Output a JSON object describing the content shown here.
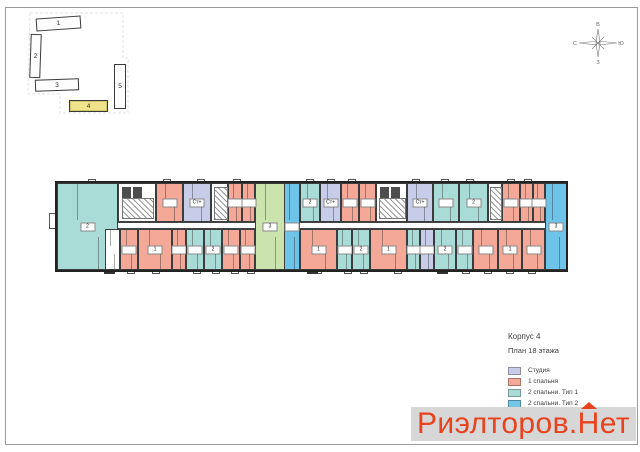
{
  "info": {
    "title": "Корпус 4",
    "subtitle": "План 18 этажа"
  },
  "legend": {
    "items": [
      {
        "label": "Студия",
        "color": "#c7cce9"
      },
      {
        "label": "1 спальня",
        "color": "#f4a897"
      },
      {
        "label": "2 спальни. Тип 1",
        "color": "#a9dcd6"
      },
      {
        "label": "2 спальни. Тип 2",
        "color": "#74c6e6"
      },
      {
        "label": "3 спальни",
        "color": "#cbe3ac"
      }
    ]
  },
  "watermark": {
    "prefix": "Риэлторов.",
    "n": "Н",
    "suffix": "ет",
    "color": "#e8421e",
    "band_color": "#d7d7d7"
  },
  "compass": {
    "top": "В",
    "right": "Ю",
    "bottom": "З",
    "left": "С"
  },
  "keyplan": {
    "highlight_color": "#efe48c",
    "bars": [
      {
        "num": "1",
        "x": 36,
        "y": 17,
        "w": 45,
        "h": 13,
        "rot": -4,
        "highlight": false
      },
      {
        "num": "2",
        "x": 30,
        "y": 34,
        "w": 11,
        "h": 44,
        "rot": 2,
        "highlight": false
      },
      {
        "num": "3",
        "x": 35,
        "y": 79,
        "w": 44,
        "h": 12,
        "rot": -2,
        "highlight": false
      },
      {
        "num": "4",
        "x": 69,
        "y": 100,
        "w": 39,
        "h": 12,
        "rot": 0,
        "highlight": true
      },
      {
        "num": "5",
        "x": 114,
        "y": 64,
        "w": 12,
        "h": 45,
        "rot": 0,
        "highlight": false
      }
    ]
  },
  "plan": {
    "colors": {
      "studio": "#c7cce9",
      "bed1": "#f4a897",
      "bed2t1": "#a9dcd6",
      "bed2t2": "#6ec3e8",
      "bed3": "#cbe3ac",
      "white": "#ffffff"
    },
    "geometry": {
      "left": 57,
      "right": 567,
      "top": 183,
      "corridor_top": 222,
      "corridor_h": 7,
      "bottom": 270
    },
    "corridors": [
      {
        "x": 100,
        "w": 155
      },
      {
        "x": 300,
        "w": 245
      }
    ],
    "units": [
      {
        "row": "full",
        "x": 57,
        "w": 61,
        "c": "bed2t1",
        "tag": "2"
      },
      {
        "row": "full",
        "x": 255,
        "w": 30,
        "c": "bed3",
        "tag": "3"
      },
      {
        "row": "full",
        "x": 284,
        "w": 16,
        "c": "bed2t2",
        "tag": ""
      },
      {
        "row": "full",
        "x": 545,
        "w": 22,
        "c": "bed2t2",
        "tag": "3"
      },
      {
        "row": "top",
        "x": 156,
        "w": 27,
        "c": "bed1",
        "tag": ""
      },
      {
        "row": "top",
        "x": 183,
        "w": 28,
        "c": "studio",
        "tag": "Ст+"
      },
      {
        "row": "top",
        "x": 228,
        "w": 14,
        "c": "bed1",
        "tag": ""
      },
      {
        "row": "top",
        "x": 242,
        "w": 13,
        "c": "bed1",
        "tag": ""
      },
      {
        "row": "top",
        "x": 300,
        "w": 20,
        "c": "bed2t1",
        "tag": "2"
      },
      {
        "row": "top",
        "x": 320,
        "w": 21,
        "c": "studio",
        "tag": "Ст+"
      },
      {
        "row": "top",
        "x": 341,
        "w": 18,
        "c": "bed1",
        "tag": ""
      },
      {
        "row": "top",
        "x": 359,
        "w": 17,
        "c": "bed1",
        "tag": ""
      },
      {
        "row": "top",
        "x": 407,
        "w": 26,
        "c": "studio",
        "tag": "Ст+"
      },
      {
        "row": "top",
        "x": 433,
        "w": 26,
        "c": "bed2t1",
        "tag": ""
      },
      {
        "row": "top",
        "x": 459,
        "w": 29,
        "c": "bed2t1",
        "tag": "2"
      },
      {
        "row": "top",
        "x": 502,
        "w": 18,
        "c": "bed1",
        "tag": ""
      },
      {
        "row": "top",
        "x": 520,
        "w": 13,
        "c": "bed1",
        "tag": ""
      },
      {
        "row": "top",
        "x": 533,
        "w": 12,
        "c": "bed1",
        "tag": ""
      },
      {
        "row": "bottom",
        "x": 105,
        "w": 15,
        "c": "white",
        "tag": ""
      },
      {
        "row": "bottom",
        "x": 120,
        "w": 18,
        "c": "bed1",
        "tag": ""
      },
      {
        "row": "bottom",
        "x": 138,
        "w": 34,
        "c": "bed1",
        "tag": "1"
      },
      {
        "row": "bottom",
        "x": 172,
        "w": 14,
        "c": "bed1",
        "tag": ""
      },
      {
        "row": "bottom",
        "x": 186,
        "w": 18,
        "c": "bed2t1",
        "tag": ""
      },
      {
        "row": "bottom",
        "x": 204,
        "w": 18,
        "c": "bed2t1",
        "tag": "2"
      },
      {
        "row": "bottom",
        "x": 222,
        "w": 18,
        "c": "bed1",
        "tag": ""
      },
      {
        "row": "bottom",
        "x": 240,
        "w": 15,
        "c": "bed1",
        "tag": ""
      },
      {
        "row": "bottom",
        "x": 300,
        "w": 37,
        "c": "bed1",
        "tag": "1"
      },
      {
        "row": "bottom",
        "x": 337,
        "w": 15,
        "c": "bed2t1",
        "tag": ""
      },
      {
        "row": "bottom",
        "x": 352,
        "w": 18,
        "c": "bed2t1",
        "tag": "2"
      },
      {
        "row": "bottom",
        "x": 370,
        "w": 37,
        "c": "bed1",
        "tag": "1"
      },
      {
        "row": "bottom",
        "x": 407,
        "w": 13,
        "c": "bed2t1",
        "tag": ""
      },
      {
        "row": "bottom",
        "x": 420,
        "w": 14,
        "c": "studio",
        "tag": ""
      },
      {
        "row": "bottom",
        "x": 434,
        "w": 22,
        "c": "bed2t1",
        "tag": "2"
      },
      {
        "row": "bottom",
        "x": 456,
        "w": 17,
        "c": "bed2t1",
        "tag": ""
      },
      {
        "row": "bottom",
        "x": 473,
        "w": 25,
        "c": "bed1",
        "tag": ""
      },
      {
        "row": "bottom",
        "x": 498,
        "w": 24,
        "c": "bed1",
        "tag": "1"
      },
      {
        "row": "bottom",
        "x": 522,
        "w": 23,
        "c": "bed1",
        "tag": ""
      }
    ],
    "cores": [
      {
        "x": 118,
        "w": 38,
        "type": "core"
      },
      {
        "x": 211,
        "w": 17,
        "type": "stair"
      },
      {
        "x": 376,
        "w": 31,
        "type": "core"
      },
      {
        "x": 488,
        "w": 14,
        "type": "stair"
      }
    ],
    "ticks_top": [
      88,
      163,
      197,
      233,
      306,
      327,
      348,
      412,
      441,
      466,
      507,
      524
    ],
    "ticks_bottom": [
      127,
      152,
      193,
      212,
      231,
      247,
      314,
      344,
      360,
      394,
      440,
      462,
      484,
      506,
      528
    ],
    "stubs_bottom": [
      104,
      307,
      437
    ]
  }
}
